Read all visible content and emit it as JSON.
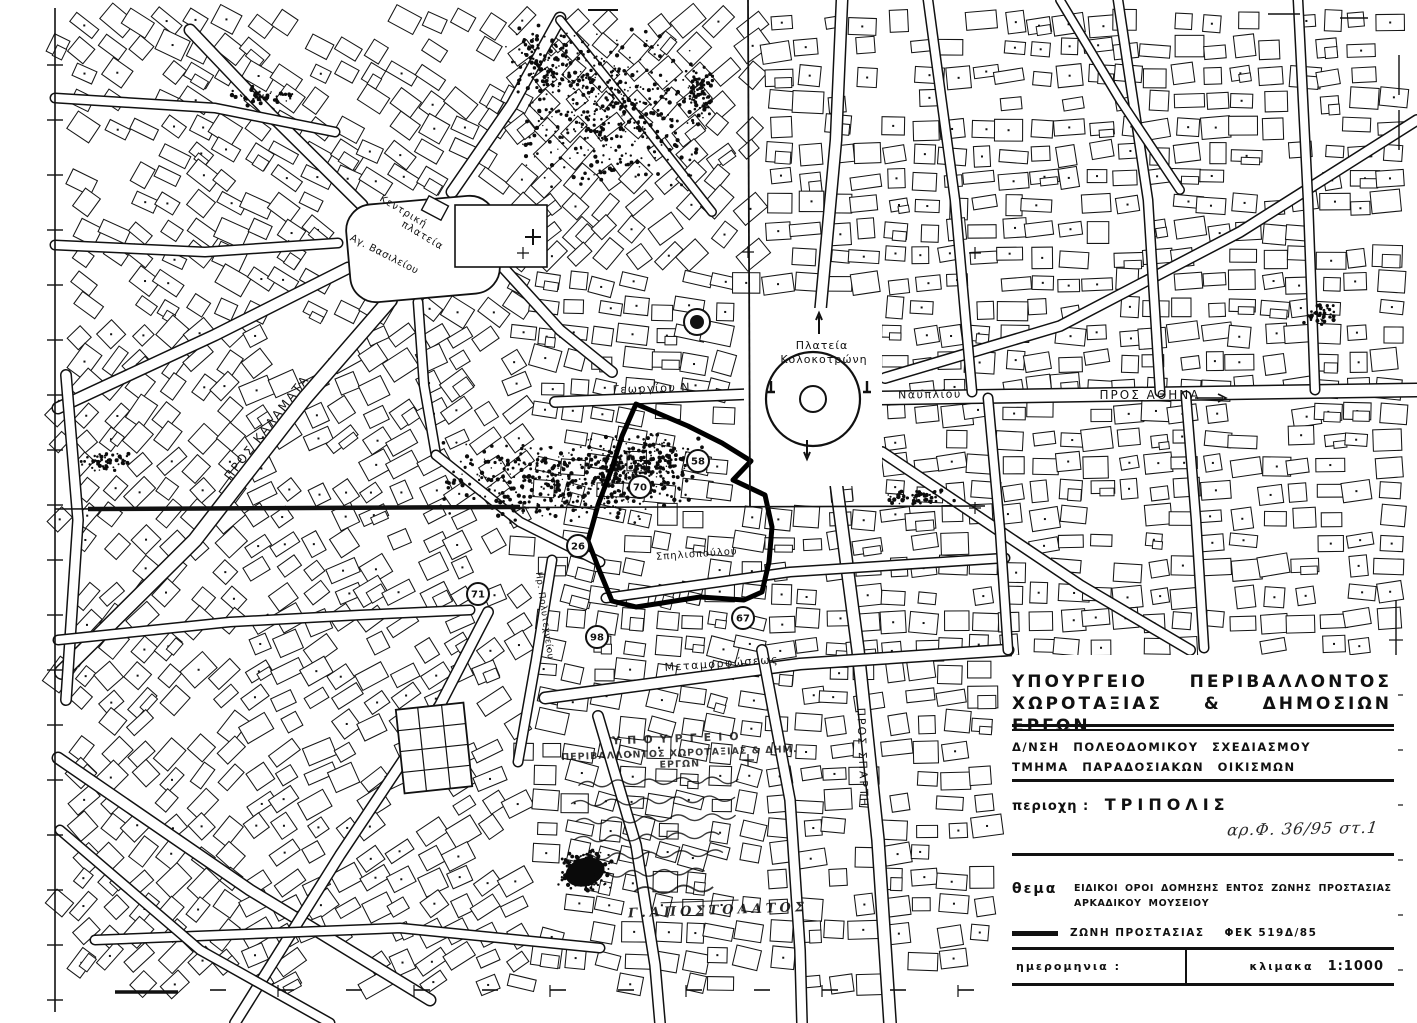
{
  "colors": {
    "ink": "#111111",
    "paper": "#ffffff",
    "accent_zone": "#000000"
  },
  "map": {
    "labels": [
      {
        "text": "Κεντρική",
        "x": 402,
        "y": 214,
        "rot": 31,
        "fs": 10,
        "ls": 1
      },
      {
        "text": "πλατεία",
        "x": 421,
        "y": 238,
        "rot": 31,
        "fs": 10,
        "ls": 1
      },
      {
        "text": "Αγ. Βασιλείου",
        "x": 383,
        "y": 257,
        "rot": 27,
        "fs": 10,
        "ls": 0.5
      },
      {
        "text": "Πλατεία",
        "x": 822,
        "y": 349,
        "rot": 0,
        "fs": 11,
        "ls": 1
      },
      {
        "text": "Κολοκοτρώνη",
        "x": 824,
        "y": 363,
        "rot": 0,
        "fs": 11,
        "ls": 1
      },
      {
        "text": "Γεωργίου Ν",
        "x": 652,
        "y": 392,
        "rot": -2,
        "fs": 11,
        "ls": 1.5
      },
      {
        "text": "Ναυπλίου",
        "x": 930,
        "y": 398,
        "rot": -1,
        "fs": 11,
        "ls": 1.5
      },
      {
        "text": "ΠΡΟΣ ΑΘΗΝΑ",
        "x": 1150,
        "y": 399,
        "rot": 0,
        "fs": 12,
        "ls": 2
      },
      {
        "text": "ΠΡΟΣ ΚΑΛΑΜΑΤΑ",
        "x": 270,
        "y": 430,
        "rot": -52,
        "fs": 12,
        "ls": 2
      },
      {
        "text": "Μεταμορφώσεως",
        "x": 722,
        "y": 667,
        "rot": -4,
        "fs": 11,
        "ls": 1.5
      },
      {
        "text": "Σπηλιοπούλου",
        "x": 697,
        "y": 557,
        "rot": -4,
        "fs": 10,
        "ls": 1
      },
      {
        "text": "ΠΡΟΣ ΣΠΑΡΤΗ",
        "x": 859,
        "y": 758,
        "rot": 88,
        "fs": 11,
        "ls": 2
      },
      {
        "text": "Ηρ. Πολυτεχνείου",
        "x": 542,
        "y": 616,
        "rot": 82,
        "fs": 9,
        "ls": 0.5
      }
    ],
    "markers": [
      {
        "value": "58",
        "x": 698,
        "y": 461
      },
      {
        "value": "70",
        "x": 640,
        "y": 487
      },
      {
        "value": "26",
        "x": 578,
        "y": 546
      },
      {
        "value": "71",
        "x": 478,
        "y": 594
      },
      {
        "value": "98",
        "x": 597,
        "y": 637
      },
      {
        "value": "67",
        "x": 743,
        "y": 618
      }
    ],
    "signature": "Γ.ΑΠΟΣΤΟΛΑΤΟΣ"
  },
  "stamp": {
    "header1": "ΥΠΟΥΡΓΕΙΟ",
    "header2": "ΠΕΡΙΒΑΛΛΟΝΤΟΣ  ΧΩΡΟΤΑΞΙΑΣ  &  ΔΗΜ.  ΕΡΓΩΝ"
  },
  "titleblock": {
    "ministry_line1": "ΥΠΟΥΡΓΕΙΟ ΠΕΡΙΒΑΛΛΟΝΤΟΣ",
    "ministry_line2": "ΧΩΡΟΤΑΞΙΑΣ & ΔΗΜΟΣΙΩΝ ΕΡΓΩΝ",
    "dept_line1": "Δ/ΝΣΗ ΠΟΛΕΟΔΟΜΙΚΟΥ ΣΧΕΔΙΑΣΜΟΥ",
    "dept_line2": "ΤΜΗΜΑ ΠΑΡΑΔΟΣΙΑΚΩΝ ΟΙΚΙΣΜΩΝ",
    "area_label": "περιοχη :",
    "area_value": "ΤΡΙΠΟΛΙΣ",
    "protocol_note": "αρ.Φ. 36/95 στ.1",
    "subject_label": "θεμα",
    "subject_text": "ΕΙΔΙΚΟΙ ΟΡΟΙ ΔΟΜΗΣΗΣ ΕΝΤΟΣ ΖΩΝΗΣ ΠΡΟΣΤΑΣΙΑΣ ΑΡΚΑΔΙΚΟΥ ΜΟΥΣΕΙΟΥ",
    "legend_label": "ΖΩΝΗ ΠΡΟΣΤΑΣΙΑΣ",
    "legend_ref": "ΦΕΚ 519Δ/85",
    "date_label": "ημερομηνια :",
    "scale_label": "κλιμακα",
    "scale_value": "1:1000"
  }
}
